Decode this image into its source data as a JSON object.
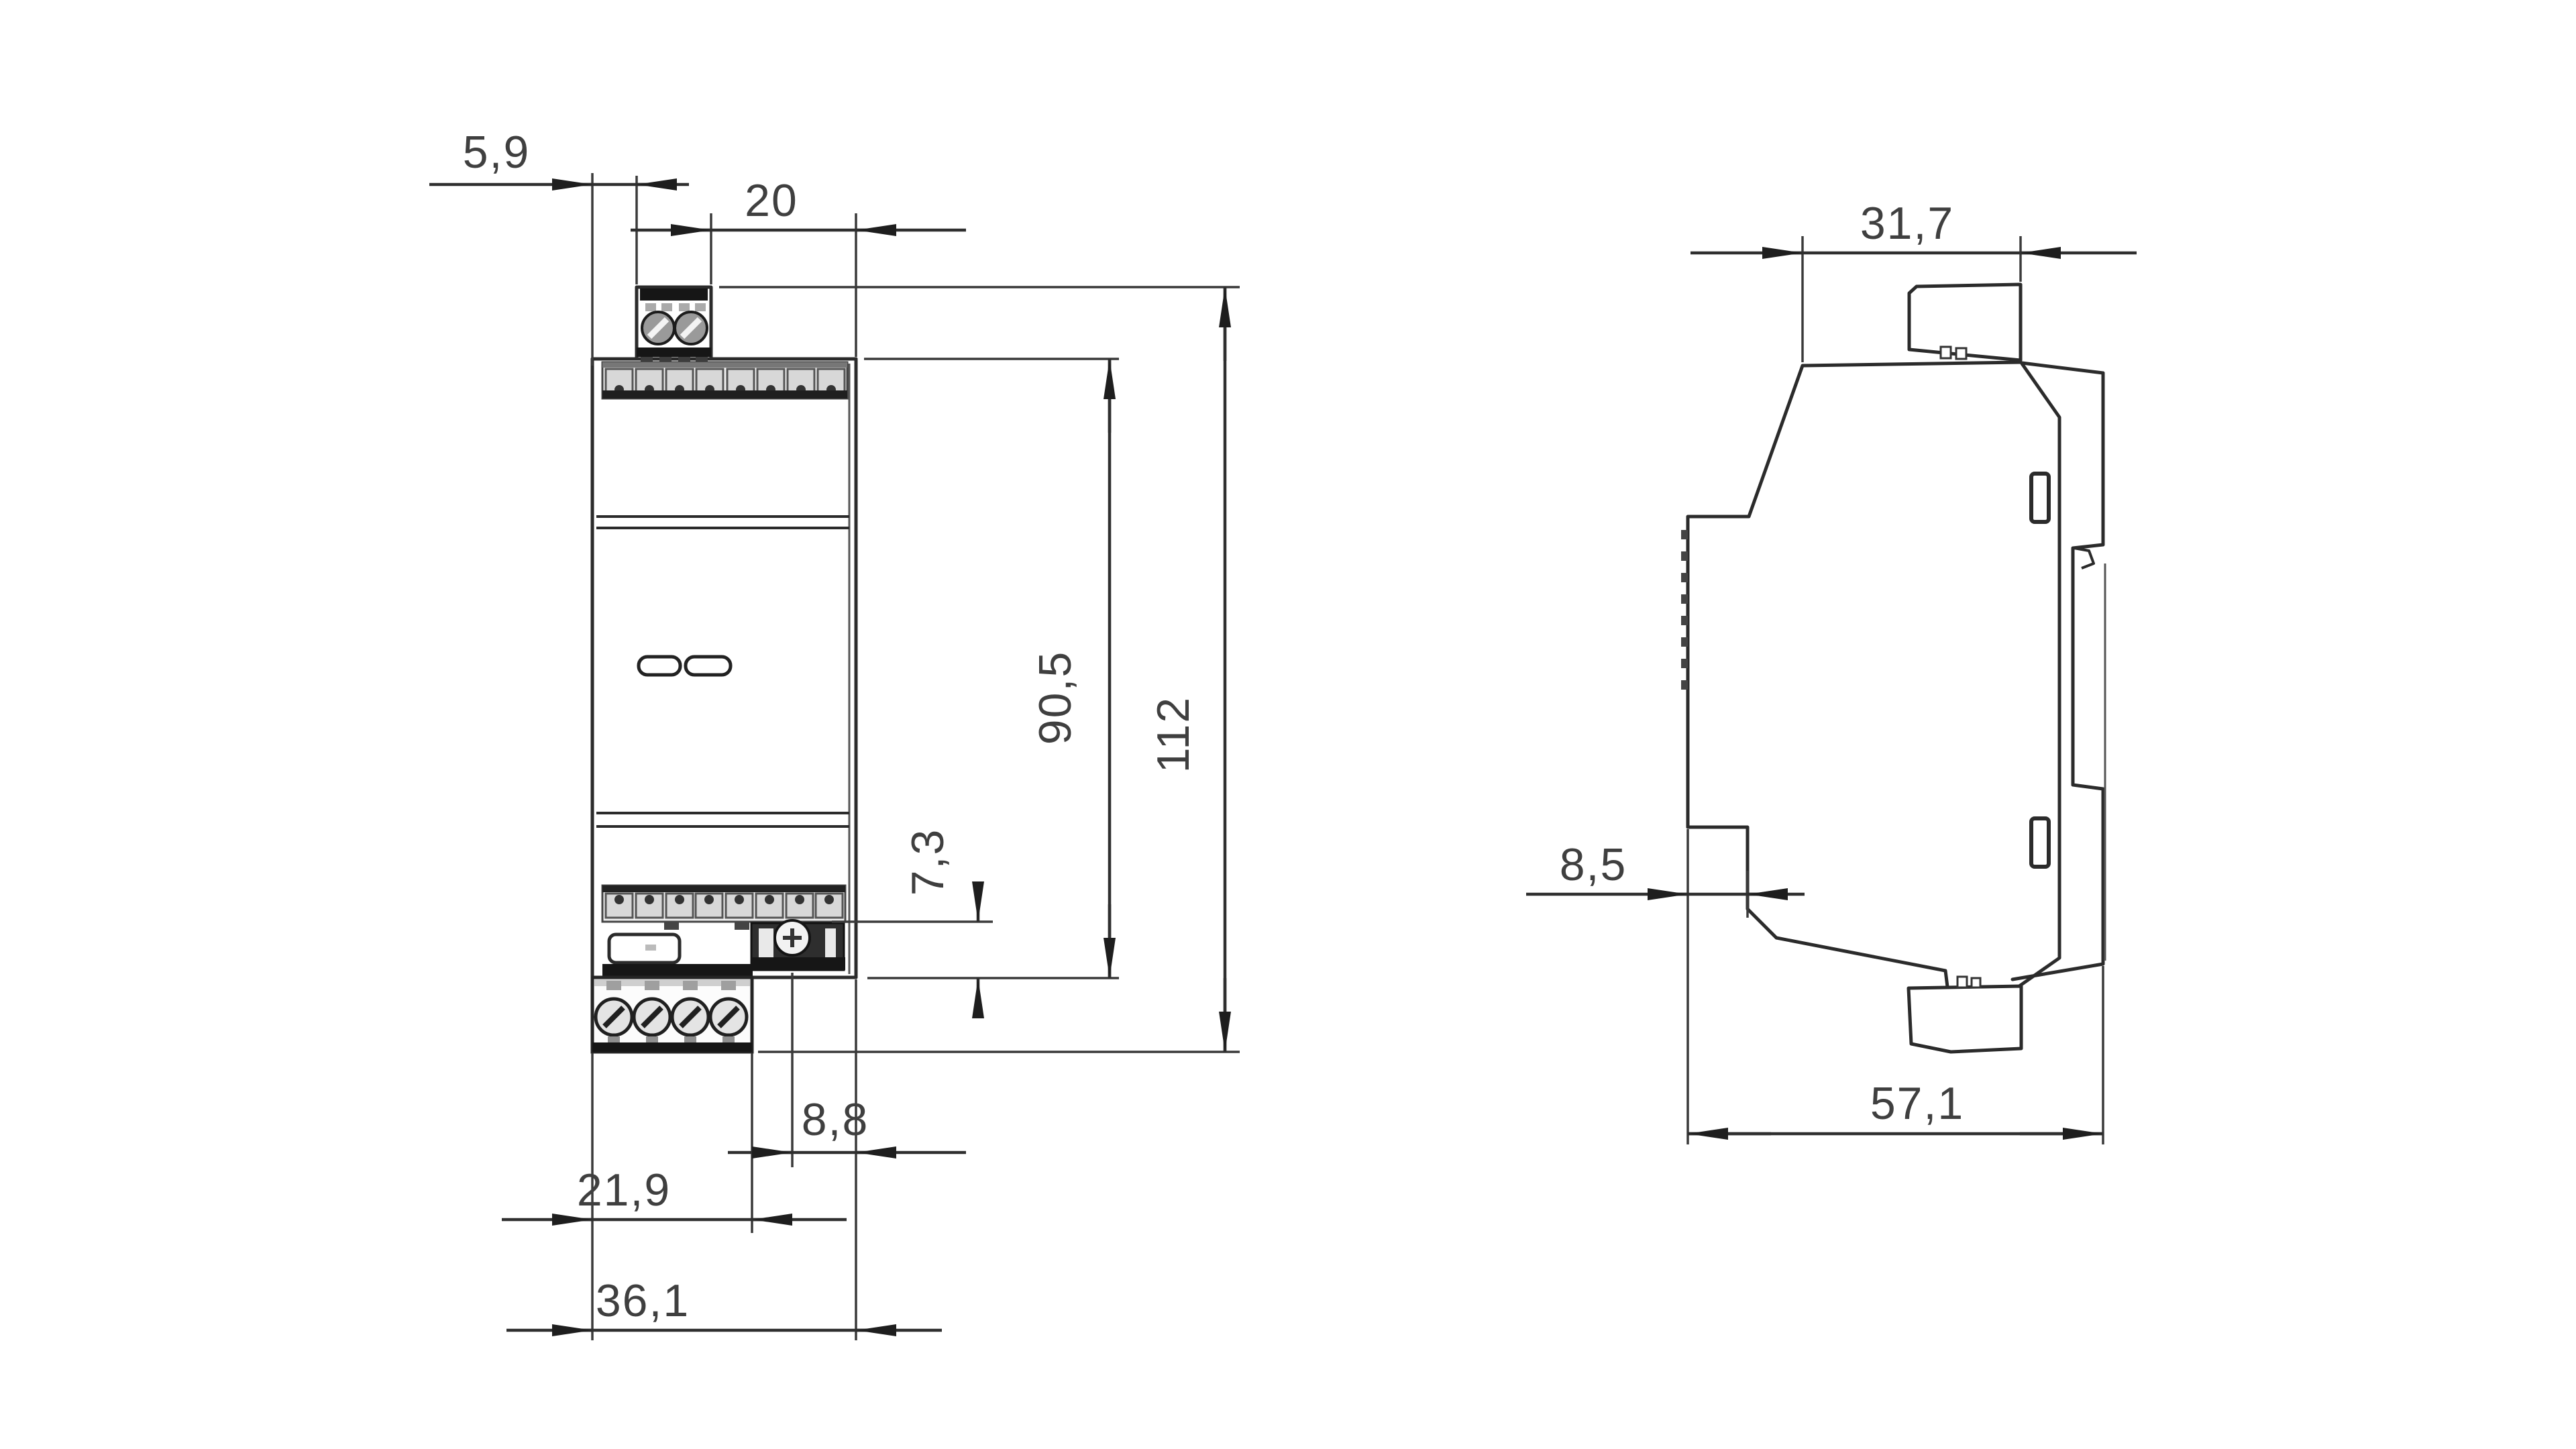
{
  "front_view": {
    "dims": {
      "left_offset": "5,9",
      "right_width": "20",
      "housing_height": "90,5",
      "total_height": "112",
      "connector_height": "7,3",
      "connector_to_edge": "8,8",
      "terminal_width": "21,9",
      "total_width": "36,1"
    }
  },
  "side_view": {
    "dims": {
      "front_depth": "31,7",
      "notch_depth": "8,5",
      "total_depth": "57,1"
    }
  },
  "colors": {
    "line": "#2b2b2b",
    "label": "#3f3f3f",
    "dark_fill": "#161616",
    "clamp_fill": "#d8d8d8"
  }
}
